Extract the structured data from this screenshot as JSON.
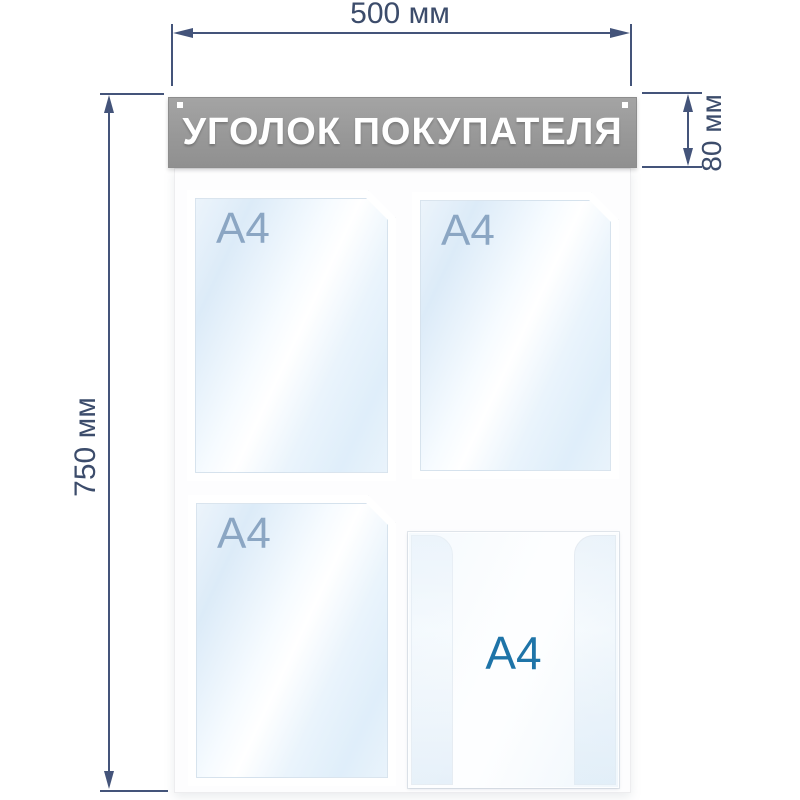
{
  "board": {
    "header": {
      "title": "УГОЛОК ПОКУПАТЕЛЯ"
    },
    "pockets": [
      {
        "position": "top-left",
        "type": "flat",
        "label": "A4"
      },
      {
        "position": "top-right",
        "type": "flat",
        "label": "A4"
      },
      {
        "position": "bottom-left",
        "type": "flat",
        "label": "A4"
      },
      {
        "position": "bottom-right",
        "type": "volumetric",
        "label": "A4"
      }
    ]
  },
  "dimensions": {
    "width": "500 мм",
    "height": "750 мм",
    "header_height": "80 мм"
  },
  "colors": {
    "dimension_annotation": "#44547a",
    "header_background": "#9b9b9b",
    "header_text": "#ffffff",
    "flat_pocket_label": "#8ba6c3",
    "volumetric_pocket_label": "#1e74a8",
    "background": "#ffffff"
  }
}
